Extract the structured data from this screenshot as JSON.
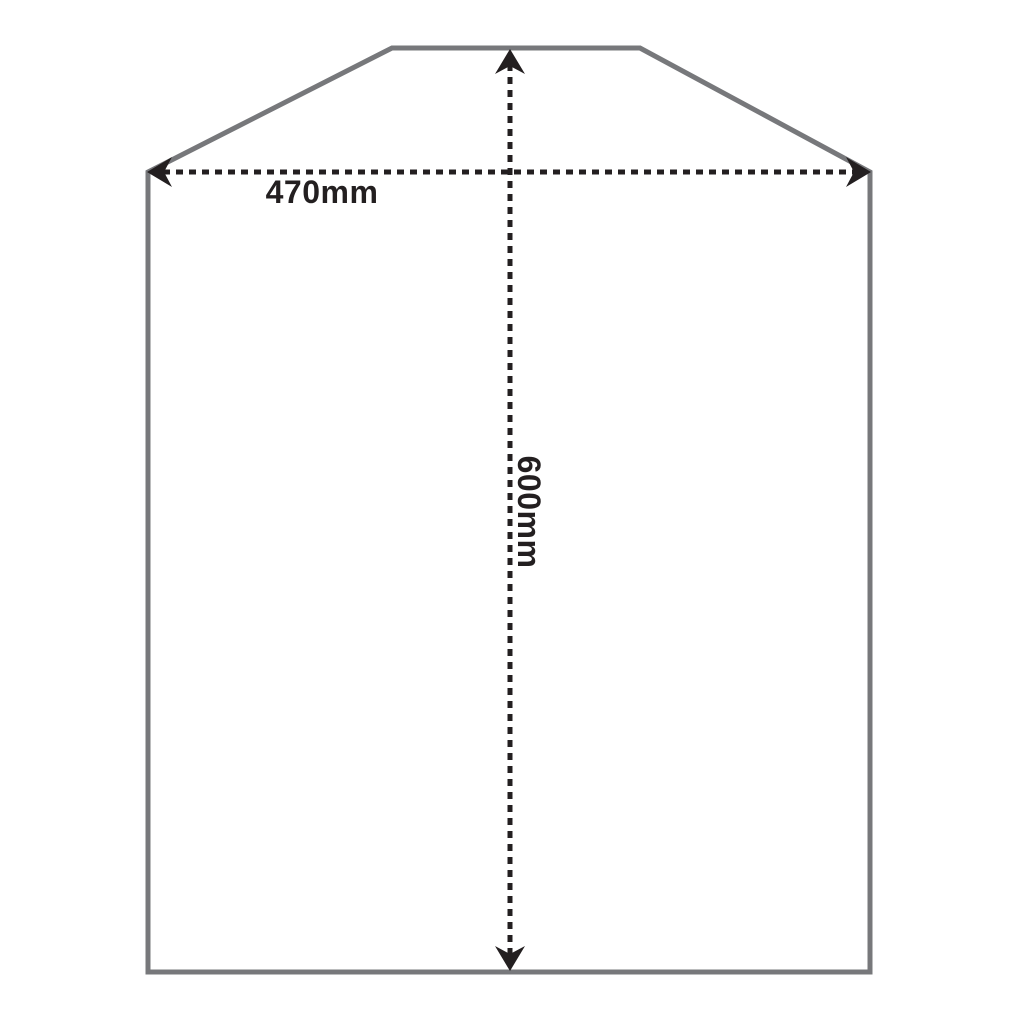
{
  "diagram": {
    "labels": {
      "width": "470mm",
      "height": "600mm"
    },
    "colors": {
      "outline": "#77787b",
      "dimension": "#231f20",
      "background": "#ffffff"
    }
  }
}
